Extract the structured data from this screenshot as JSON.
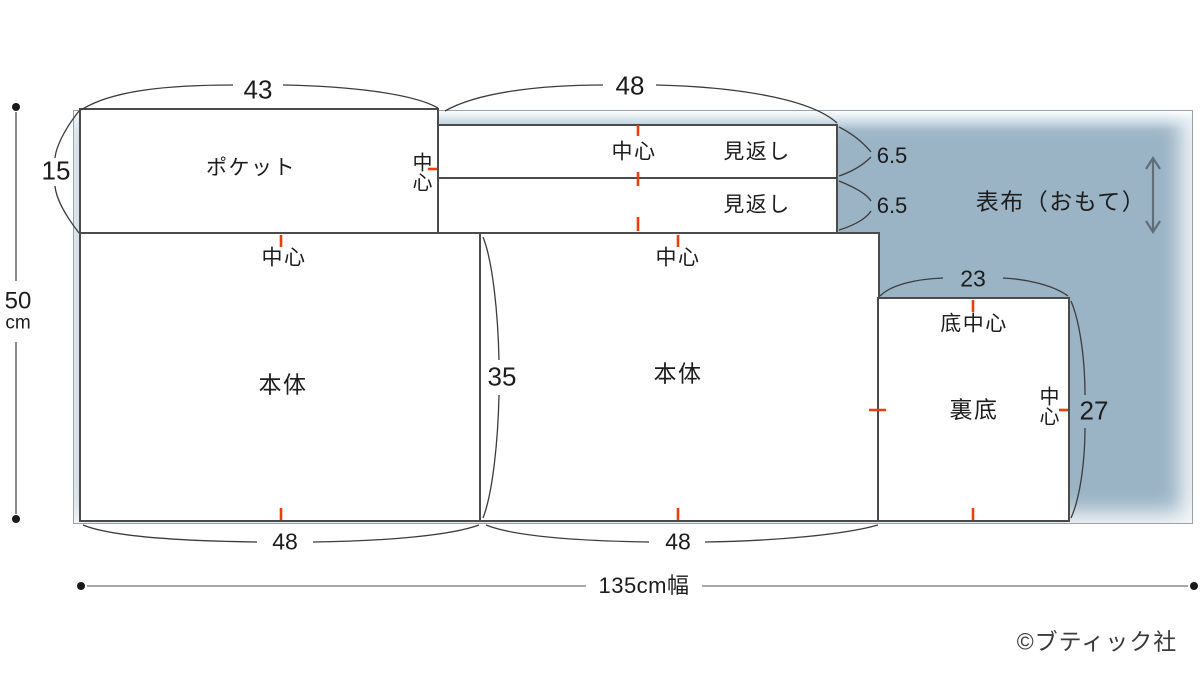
{
  "fabric": {
    "label": "表布（おもて）",
    "width_label": "135cm幅",
    "height_value": "50",
    "height_unit": "cm",
    "color": "#9ab4c6"
  },
  "pieces": {
    "pocket": {
      "label": "ポケット",
      "center_mark": "中心",
      "width": "43",
      "height": "15"
    },
    "facing_width": "48",
    "facing_top": {
      "label": "見返し",
      "center_mark": "中心",
      "height": "6.5"
    },
    "facing_bottom": {
      "label": "見返し",
      "height": "6.5"
    },
    "body_left": {
      "label": "本体",
      "center_mark": "中心",
      "width": "48",
      "height": "35"
    },
    "body_right": {
      "label": "本体",
      "center_mark": "中心",
      "width": "48"
    },
    "lining_bottom": {
      "label": "裏底",
      "bottom_center_mark": "底中心",
      "center_mark": "中心",
      "width": "23",
      "height": "27"
    }
  },
  "marks": {
    "center_mark_color": "#e8400c"
  },
  "copyright": "©ブティック社"
}
